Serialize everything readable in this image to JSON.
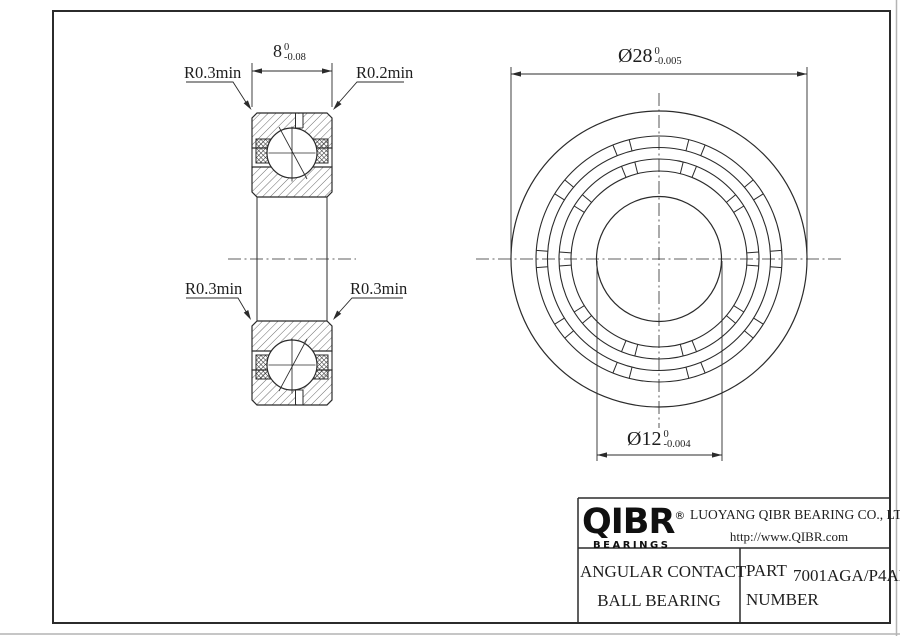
{
  "drawing": {
    "bg": "#ffffff",
    "line_color": "#2b2b2b",
    "section_view": {
      "width_dim": {
        "nominal": "8",
        "upper": "0",
        "lower": "-0.08"
      },
      "corner_labels": {
        "top_left": "R0.3min",
        "top_right": "R0.2min",
        "mid_left": "R0.3min",
        "mid_right": "R0.3min"
      }
    },
    "front_view": {
      "outer_dim": {
        "nominal": "Ø28",
        "upper": "0",
        "lower": "-0.005"
      },
      "bore_dim": {
        "nominal": "Ø12",
        "upper": "0",
        "lower": "-0.004"
      }
    }
  },
  "title_block": {
    "logo_text": "QIBR",
    "logo_reg": "®",
    "logo_sub": "BEARINGS",
    "company": "LUOYANG QIBR BEARING CO., LTD",
    "website": "http://www.QIBR.com",
    "product_line1": "ANGULAR CONTACT",
    "product_line2": "BALL BEARING",
    "part_label1": "PART",
    "part_label2": "NUMBER",
    "part_number": "7001AGA/P4AH"
  }
}
